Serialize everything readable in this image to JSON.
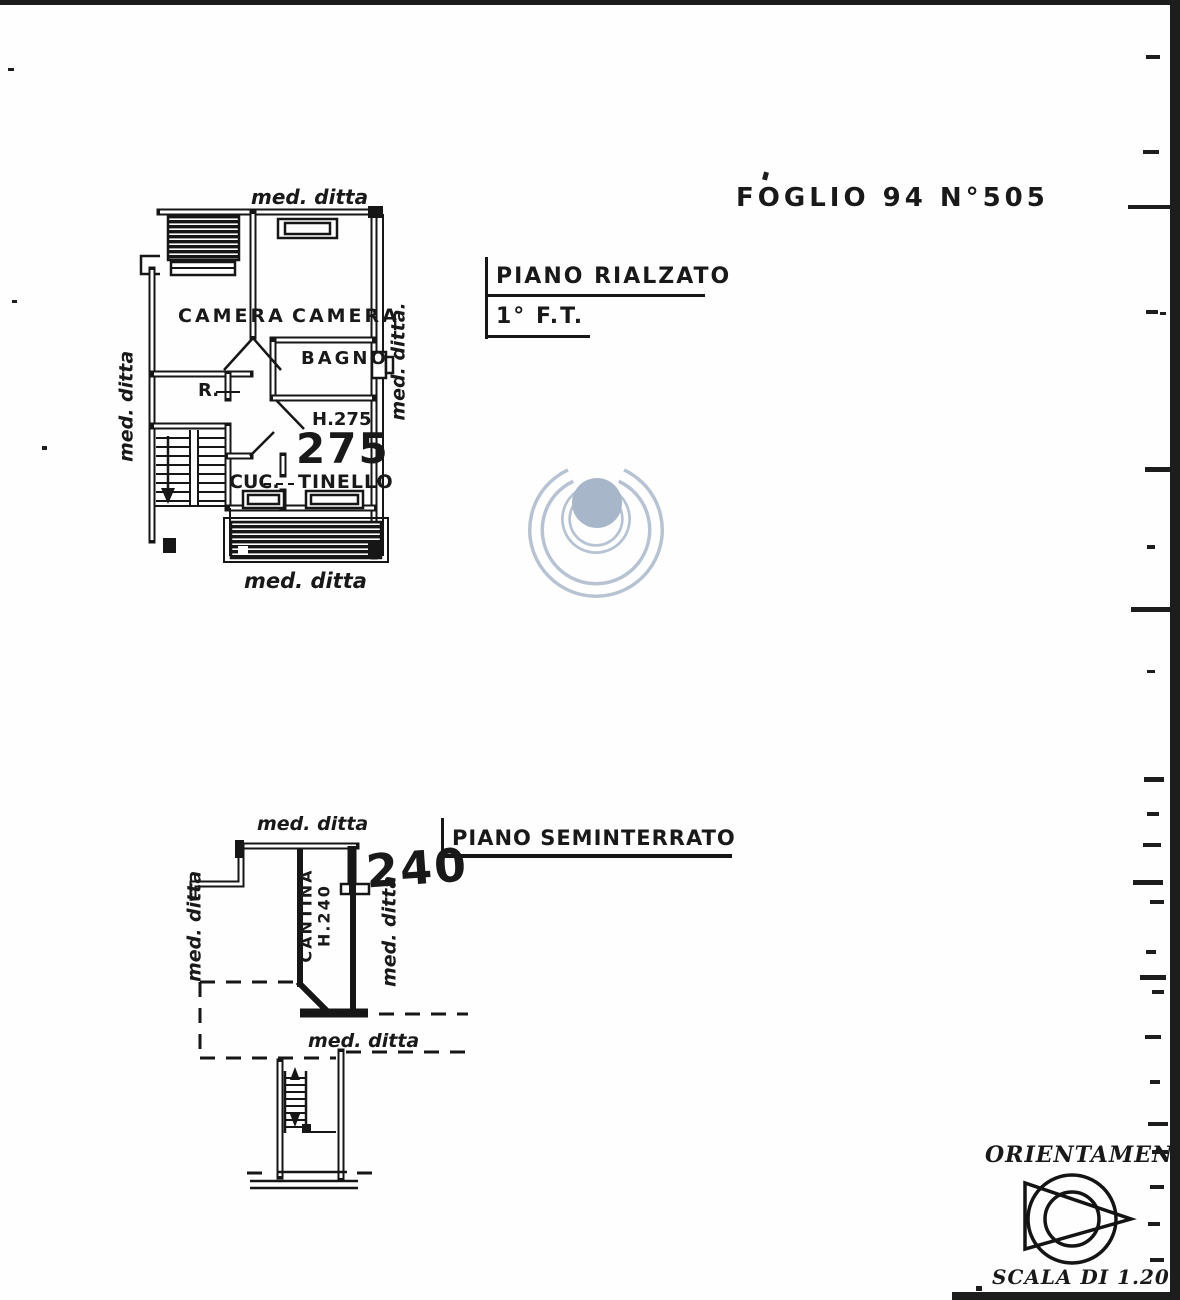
{
  "document": {
    "foglio_ref": "FOGLIO 94 N°505"
  },
  "plan_rialzato": {
    "title": "PIANO RIALZATO",
    "subtitle": "1° F.T.",
    "rooms": {
      "camera_left": "CAMERA",
      "camera_right": "CAMERA",
      "bagno": "BAGNO",
      "ripostiglio": "R.",
      "cucina": "CUC.",
      "tinello": "TINELLO"
    },
    "heights": {
      "note": "H.275",
      "value": "275"
    },
    "boundaries": {
      "top": "med. ditta",
      "left": "med. ditta",
      "right": "med. ditta.",
      "bottom": "med. ditta"
    }
  },
  "plan_seminterrato": {
    "title": "PIANO SEMINTERRATO",
    "rooms": {
      "cantina": "CANTINA",
      "cantina_height": "H.240"
    },
    "heights": {
      "value": "240"
    },
    "boundaries": {
      "top": "med. ditta",
      "left": "med. ditta",
      "right": "med. ditta",
      "bottom": "med. ditta"
    }
  },
  "orientation": {
    "title": "ORIENTAMENTO",
    "scale": "SCALA DI 1.200"
  },
  "colors": {
    "ink": "#1b1b1b",
    "paper": "#ffffff",
    "watermark_stroke": "#b7c3d3",
    "watermark_fill": "#a7b6c9"
  }
}
